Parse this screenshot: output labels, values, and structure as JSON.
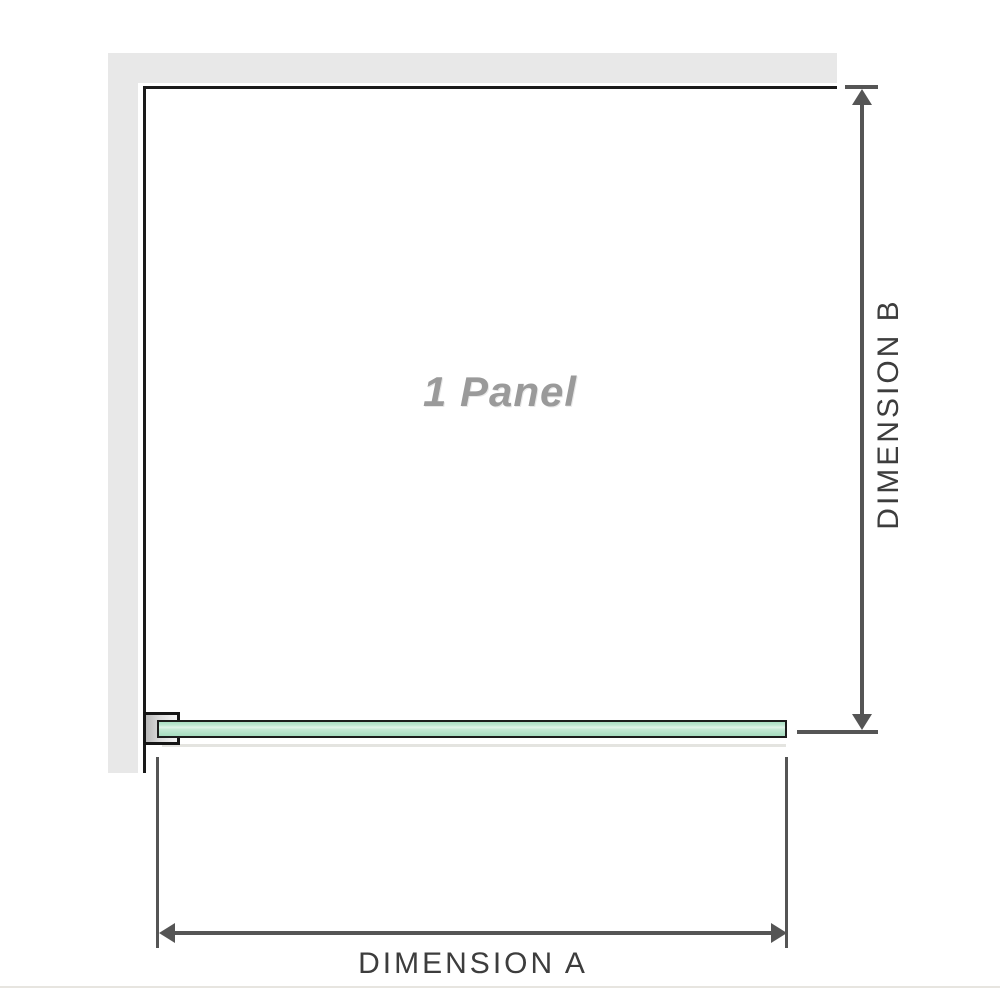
{
  "diagram": {
    "panel_label": "1 Panel",
    "dimension_a_label": "DIMENSION A",
    "dimension_b_label": "DIMENSION B"
  },
  "colors": {
    "wall_gray": "#e8e8e8",
    "panel_border_black": "#1a1a1a",
    "glass_green": "#a9dfc2",
    "glass_highlight": "#e0f4e9",
    "bracket_silver": "#dcdcdc",
    "dimension_line_gray": "#555555",
    "dimension_label_text": "#3d3d3d",
    "panel_label_text": "#9a9a9a",
    "bottom_rule": "#e7e5e0"
  },
  "icons": {
    "arrow_up": "arrowhead-up-icon",
    "arrow_down": "arrowhead-down-icon",
    "arrow_left": "arrowhead-left-icon",
    "arrow_right": "arrowhead-right-icon"
  }
}
